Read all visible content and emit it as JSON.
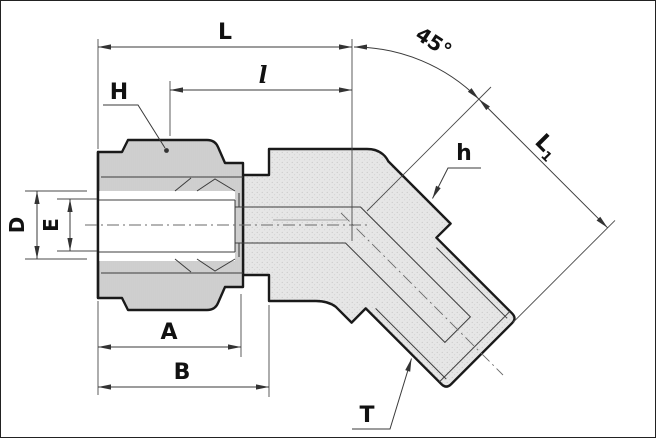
{
  "title": "45-degree male elbow tube fitting sectional drawing",
  "labels": {
    "length_total": "L",
    "length_l": "l",
    "angle": "45°",
    "L1_base": "L",
    "L1_sub": "1",
    "hex_nut": "H",
    "hex_body": "h",
    "dia_outer": "D",
    "dia_inner": "E",
    "dim_A": "A",
    "dim_B": "B",
    "thread": "T"
  },
  "colors": {
    "outline": "#1a1a1a",
    "dim_line": "#3a3a3a",
    "body_fill": "#e6e6e6",
    "nut_fill": "#d7d7d7",
    "bore": "#ffffff"
  }
}
